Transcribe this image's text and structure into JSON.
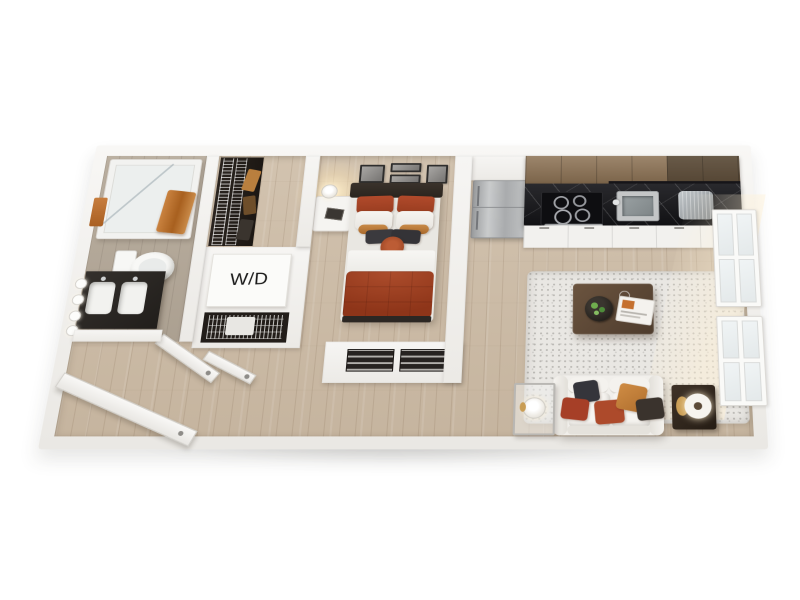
{
  "title": "3D studio apartment floor plan rendering",
  "label": {
    "washer_dryer": "W/D"
  },
  "palette": {
    "wood": "#cdbca6",
    "bathfloor": "#b5a999",
    "wallface": "#f4f3f0",
    "rust": "#a8452a",
    "rustdark": "#92371c",
    "tan": "#c58544",
    "charcoal": "#36353a",
    "counter": "#17171b",
    "cabwood": "#8c7254",
    "stainless": "#b4b6b8",
    "sofa": "#f1efeb",
    "rug": "#e9e7e3",
    "tablewood": "#5a4636",
    "towel": "#c07437"
  },
  "scene": {
    "view": "top-down 3d dollhouse perspective",
    "rooms": [
      {
        "name": "bathroom",
        "items": [
          "bathtub",
          "shower-glass",
          "toilet",
          "double-vanity",
          "vanity-lights",
          "wall-towel",
          "tub-towel",
          "bathroom-door"
        ]
      },
      {
        "name": "walk-in-closet",
        "items": [
          "wire-shelving",
          "hanging-clothes"
        ]
      },
      {
        "name": "laundry-closet",
        "items": [
          "washer-dryer",
          "wire-basket-storage",
          "closet-door"
        ]
      },
      {
        "name": "entry",
        "items": [
          "front-door"
        ]
      },
      {
        "name": "bedroom",
        "items": [
          "double-bed",
          "rust-duvet",
          "nightstand",
          "table-lamp",
          "wall-art-frames",
          "built-in-dresser"
        ]
      },
      {
        "name": "kitchen",
        "items": [
          "refrigerator",
          "upper-cabinets",
          "black-marble-counter",
          "cooktop",
          "oven",
          "sink",
          "faucet",
          "dish-rack",
          "lower-cabinets"
        ]
      },
      {
        "name": "living-room",
        "items": [
          "area-rug",
          "coffee-table",
          "succulent-bowl",
          "magazine",
          "sofa",
          "throw-pillows",
          "side-table-left",
          "side-table-right",
          "lamps",
          "windows",
          "sunlight"
        ]
      }
    ]
  }
}
